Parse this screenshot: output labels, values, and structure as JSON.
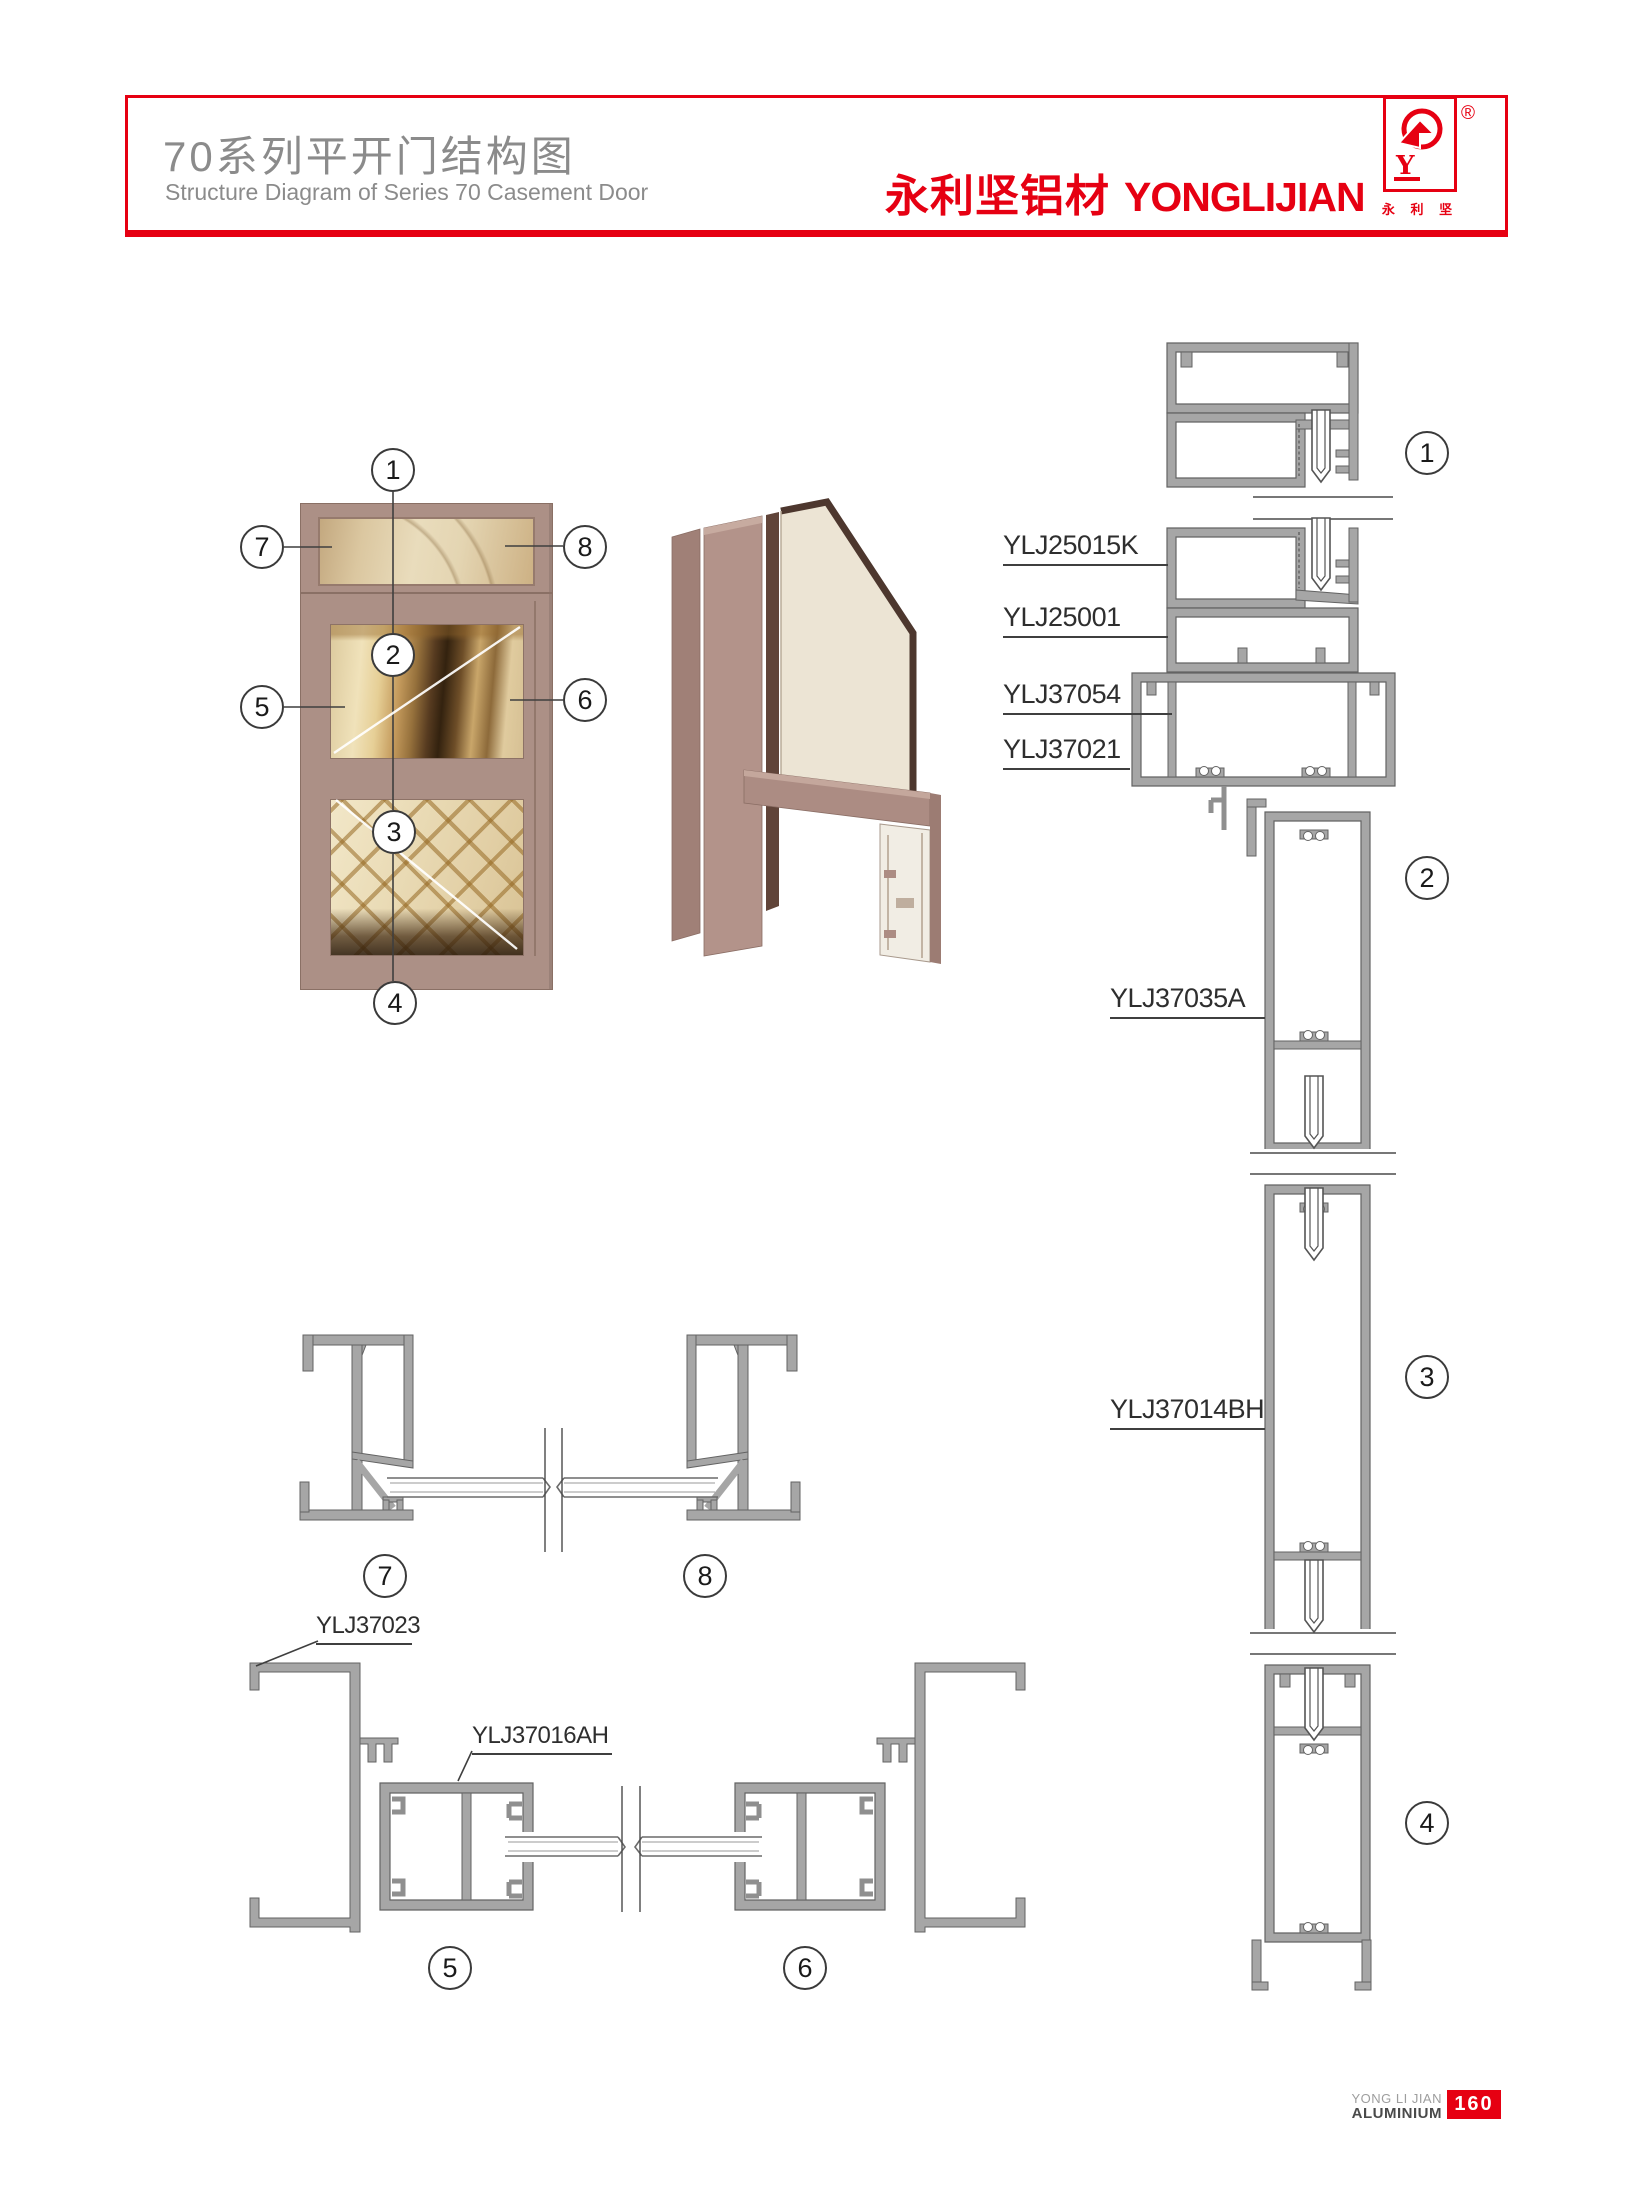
{
  "header": {
    "title_cn": "70系列平开门结构图",
    "title_en": "Structure Diagram of Series 70 Casement Door",
    "brand_cn": "永利坚铝材",
    "brand_en": "YONGLIJIAN",
    "registered_mark": "®",
    "logo_letter": "Y",
    "logo_caption": "永 利 坚"
  },
  "diagram": {
    "callouts": {
      "c1": "1",
      "c2": "2",
      "c3": "3",
      "c4": "4",
      "c5": "5",
      "c6": "6",
      "c7": "7",
      "c8": "8"
    },
    "profile_labels": {
      "l25015k": "YLJ25015K",
      "l25001": "YLJ25001",
      "l37054": "YLJ37054",
      "l37021": "YLJ37021",
      "l37035a": "YLJ37035A",
      "l37014bh": "YLJ37014BH",
      "l37023": "YLJ37023",
      "l37016ah": "YLJ37016AH"
    },
    "colors": {
      "accent_red": "#e60012",
      "profile_gray": "#a6a6a6",
      "frame_mauve": "#ac9086"
    }
  },
  "footer": {
    "brand_line1": "YONG LI JIAN",
    "brand_line2": "ALUMINIUM",
    "page_number": "160"
  }
}
